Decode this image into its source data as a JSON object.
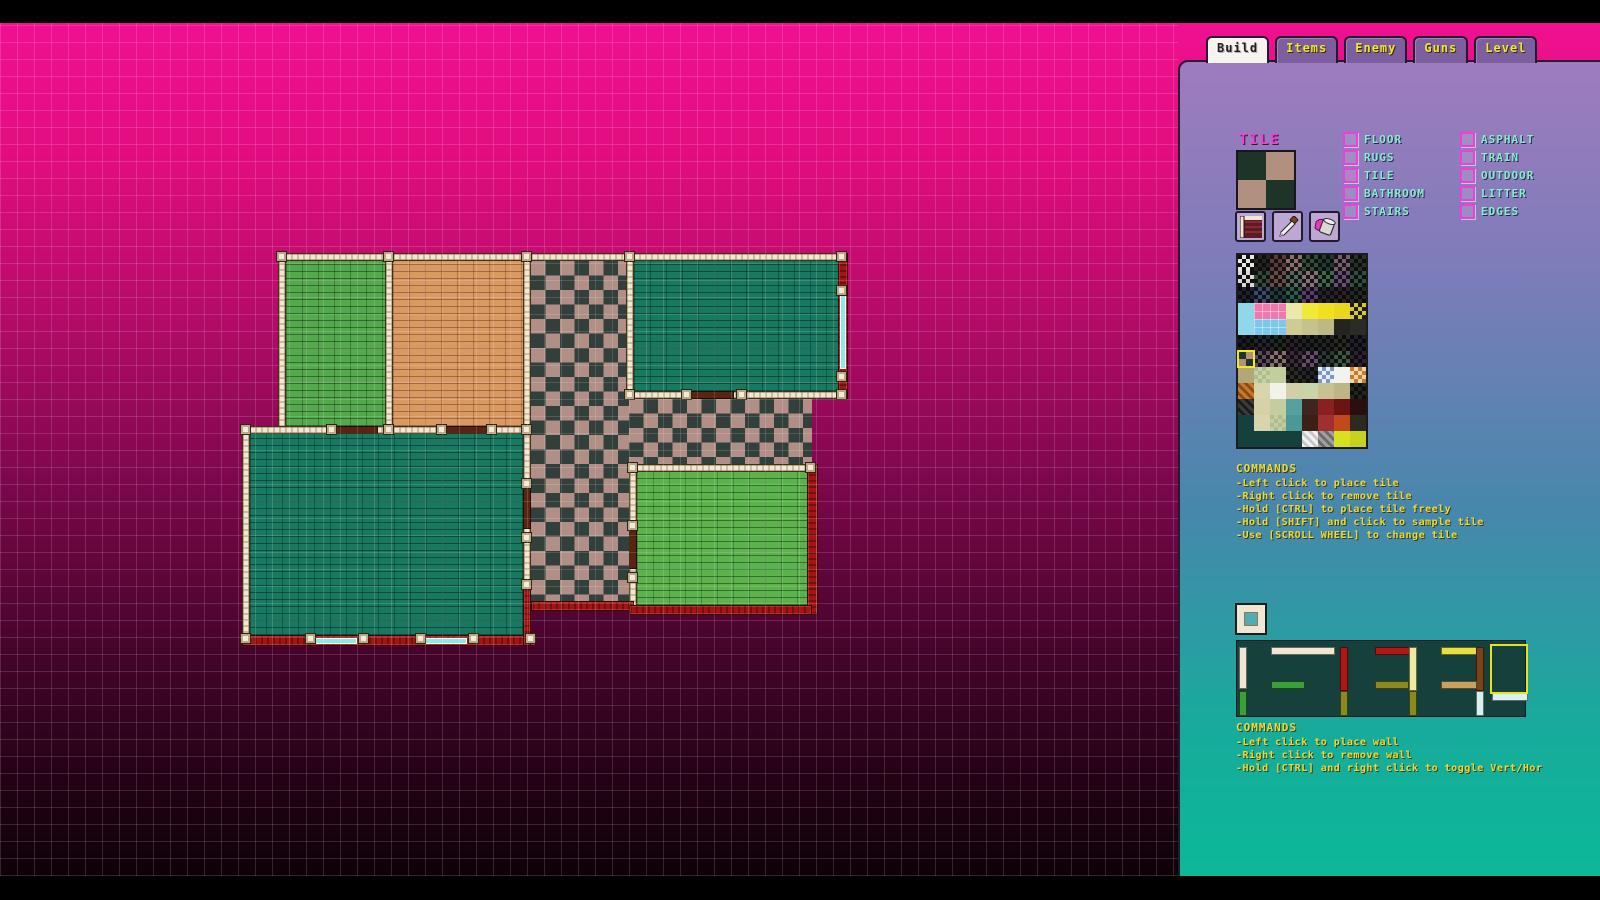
{
  "tabs": [
    {
      "label": "Build",
      "active": true
    },
    {
      "label": "Items",
      "active": false
    },
    {
      "label": "Enemy",
      "active": false
    },
    {
      "label": "Guns",
      "active": false
    },
    {
      "label": "Level",
      "active": false
    }
  ],
  "tile_section": {
    "title": "TILE",
    "preview_colors": {
      "dark": "#1f3428",
      "light": "#b2907f"
    },
    "tools": [
      "wall-pattern-tool",
      "eyedropper-tool",
      "paint-bucket-tool"
    ],
    "categories_col1": [
      {
        "label": "FLOOR",
        "checked": false
      },
      {
        "label": "RUGS",
        "checked": false
      },
      {
        "label": "TILE",
        "checked": true
      },
      {
        "label": "BATHROOM",
        "checked": false
      },
      {
        "label": "STAIRS",
        "checked": false
      }
    ],
    "categories_col2": [
      {
        "label": "ASPHALT",
        "checked": false
      },
      {
        "label": "TRAIN",
        "checked": false
      },
      {
        "label": "OUTDOOR",
        "checked": false
      },
      {
        "label": "LITTER",
        "checked": false
      },
      {
        "label": "EDGES",
        "checked": false
      }
    ]
  },
  "tile_commands": {
    "title": "COMMANDS",
    "lines": [
      "-Left click to place tile",
      "-Right click to remove tile",
      "-Hold [CTRL] to place tile freely",
      "-Hold [SHIFT] and click to sample tile",
      "-Use [SCROLL WHEEL] to change tile"
    ]
  },
  "wall_commands": {
    "title": "COMMANDS",
    "lines": [
      "-Left click to place wall",
      "-Right click to remove wall",
      "-Hold [CTRL] and right click to toggle Vert/Hor"
    ]
  },
  "tile_palette": {
    "cell": 16,
    "selected": {
      "row": 6,
      "col": 0
    },
    "rows": [
      [
        "chk:#e8e8e8/#111111",
        "chk:#23231f/#0d0d0d",
        "chk:#5e3a38/#121212",
        "chk:#8d6f6b/#161616",
        "chk:#2f4f38/#101010",
        "chk:#1f3b33/#0e0e0e",
        "chk:#7d5a74/#141414",
        "chk:#28322a/#0e0e0e"
      ],
      [
        "chk:#101010/#d8d8d8",
        "chk:#334b3b/#101010",
        "chk:#6e4a42/#121212",
        "chk:#56695e/#111111",
        "chk:#8d6f77/#151515",
        "chk:#3d6b4a/#111111",
        "chk:#6b4a7d/#131313",
        "chk:#2f4f3f/#0f0f0f"
      ],
      [
        "chk:#1b2333/#0b0b0b",
        "chk:#3b4b6b/#10101a",
        "chk:#1f3b3b/#0b1111",
        "chk:#2f5b4b/#0e1414",
        "chk:#5b3b6b/#120e16",
        "chk:#23232b/#0c0c0c",
        "chk:#2b2323/#0c0c0c",
        "chk:#1f2b23/#0b0b0b"
      ],
      [
        "sol:#8fd8ea",
        "tile:#f279ac",
        "tile:#f279ac",
        "sol:#ece9a8",
        "sol:#f2e83a",
        "sol:#f2e020",
        "sol:#ead820",
        "chk:#d8c820/#1a1a10"
      ],
      [
        "sol:#8fd8ea",
        "tile:#7cc8ea",
        "tile:#7cc8ea",
        "sol:#cfcb96",
        "sol:#c6c28e",
        "sol:#bdb986",
        "sol:#23231f",
        "sol:#2b2b27"
      ],
      [
        "chk:#1b1b1b/#0a0a0a",
        "chk:#23232b/#0b0b0b",
        "chk:#1f2b1f/#0a0a0a",
        "chk:#2b1f2b/#0b0b0b",
        "chk:#1b2323/#0a0a0a",
        "chk:#232323/#0b0b0b",
        "chk:#2b2b1f/#0b0b0b",
        "chk:#1f1f2b/#0a0a0a"
      ],
      [
        "quad:#1f3428/#b2907f",
        "chk:#5b4b5b/#121212",
        "chk:#8d6f6b/#161616",
        "chk:#3b2b3b/#0e0e0e",
        "chk:#6b4a6b/#131313",
        "chk:#2b3b33/#0d0d0d",
        "chk:#3d5b43/#101010",
        "chk:#2b2333/#0d0d0d"
      ],
      [
        "sol:#b0a878",
        "chk:#c6d2a2/#aebc8e",
        "sol:#c2ce9e",
        "chk:#2b2b23/#0e0e0e",
        "chk:#23232b/#0d0d0d",
        "chk:#7c96c8/#e8eef6",
        "sol:#f2f2ee",
        "chk:#ead8a0/#c87830"
      ],
      [
        "diag:#c87828/#8a4a14",
        "sol:#d8d5ac",
        "sol:#f2f2ea",
        "sol:#d2cfa6",
        "sol:#c9d5a9",
        "sol:#c6c292",
        "sol:#bab686",
        "chk:#23231f/#0d0d0d"
      ],
      [
        "diag:#3b3b3b/#1a1a1a",
        "sol:#d5d2a9",
        "sol:#c2ce9e",
        "sol:#56a0a0",
        "sol:#402420",
        "sol:#8a2020",
        "sol:#6b1414",
        "sol:#2b0e0e"
      ],
      [
        "sol:#173f3f",
        "sol:#d8d5ac",
        "chk:#c2ce9e/#aebc8e",
        "sol:#4a9898",
        "sol:#3b2016",
        "sol:#a03030",
        "sol:#c24a1a",
        "sol:#2b2b23"
      ],
      [
        "sol:#16403c",
        "sol:#16403c",
        "sol:#16403c",
        "sol:#16403c",
        "diag:#f2f2f2/#c8c8c8",
        "diag:#a0a0a0/#6b6b6b",
        "sol:#d8e020",
        "sol:#c8d020"
      ]
    ]
  },
  "wall_palette": {
    "bg": "#16403c",
    "segments": [
      {
        "x": 2,
        "y": 6,
        "w": 8,
        "h": 42,
        "c": "#efe7d3"
      },
      {
        "x": 2,
        "y": 50,
        "w": 8,
        "h": 25,
        "c": "#3aa03a"
      },
      {
        "x": 34,
        "y": 6,
        "w": 64,
        "h": 8,
        "c": "#efe7d3"
      },
      {
        "x": 34,
        "y": 40,
        "w": 34,
        "h": 8,
        "c": "#3aa03a"
      },
      {
        "x": 103,
        "y": 6,
        "w": 8,
        "h": 44,
        "c": "#b01818"
      },
      {
        "x": 103,
        "y": 50,
        "w": 8,
        "h": 25,
        "c": "#8a8a20"
      },
      {
        "x": 138,
        "y": 6,
        "w": 38,
        "h": 8,
        "c": "#b01818"
      },
      {
        "x": 172,
        "y": 6,
        "w": 8,
        "h": 44,
        "c": "#ece9a0"
      },
      {
        "x": 138,
        "y": 40,
        "w": 34,
        "h": 8,
        "c": "#8a8a20"
      },
      {
        "x": 172,
        "y": 50,
        "w": 8,
        "h": 25,
        "c": "#8a8a20"
      },
      {
        "x": 204,
        "y": 6,
        "w": 40,
        "h": 8,
        "c": "#e8e040"
      },
      {
        "x": 239,
        "y": 6,
        "w": 8,
        "h": 44,
        "c": "#7a4418"
      },
      {
        "x": 204,
        "y": 40,
        "w": 36,
        "h": 8,
        "c": "#c8a060"
      },
      {
        "x": 239,
        "y": 50,
        "w": 8,
        "h": 25,
        "c": "#d8f0f0"
      },
      {
        "x": 255,
        "y": 52,
        "w": 36,
        "h": 8,
        "c": "#d8f0f0"
      }
    ],
    "selected": {
      "x": 253,
      "y": 3,
      "w": 38,
      "h": 50
    }
  },
  "canvas": {
    "floors": [
      {
        "x": 286,
        "y": 238,
        "w": 99,
        "h": 165,
        "f": "greenBrick"
      },
      {
        "x": 393,
        "y": 238,
        "w": 130,
        "h": 165,
        "f": "orangeBrick"
      },
      {
        "x": 531,
        "y": 238,
        "w": 98,
        "h": 342,
        "f": "checker"
      },
      {
        "x": 634,
        "y": 238,
        "w": 204,
        "h": 130,
        "f": "tealBrick"
      },
      {
        "x": 629,
        "y": 376,
        "w": 183,
        "h": 65,
        "f": "checker"
      },
      {
        "x": 250,
        "y": 411,
        "w": 273,
        "h": 201,
        "f": "tealBrick"
      },
      {
        "x": 637,
        "y": 449,
        "w": 170,
        "h": 133,
        "f": "greenBrick2"
      }
    ],
    "white_walls": [
      {
        "x": 278,
        "y": 230,
        "w": 570,
        "h": 8
      },
      {
        "x": 278,
        "y": 230,
        "w": 8,
        "h": 181
      },
      {
        "x": 385,
        "y": 230,
        "w": 8,
        "h": 181
      },
      {
        "x": 523,
        "y": 230,
        "w": 8,
        "h": 181
      },
      {
        "x": 626,
        "y": 230,
        "w": 8,
        "h": 146
      },
      {
        "x": 626,
        "y": 368,
        "w": 222,
        "h": 8
      },
      {
        "x": 242,
        "y": 403,
        "w": 289,
        "h": 8
      },
      {
        "x": 242,
        "y": 403,
        "w": 8,
        "h": 220
      },
      {
        "x": 523,
        "y": 411,
        "w": 8,
        "h": 149
      },
      {
        "x": 629,
        "y": 441,
        "w": 183,
        "h": 8
      },
      {
        "x": 629,
        "y": 441,
        "w": 8,
        "h": 151
      }
    ],
    "red_walls": [
      {
        "x": 838,
        "y": 230,
        "w": 10,
        "h": 146
      },
      {
        "x": 242,
        "y": 612,
        "w": 294,
        "h": 11
      },
      {
        "x": 523,
        "y": 560,
        "w": 8,
        "h": 63
      },
      {
        "x": 531,
        "y": 578,
        "w": 103,
        "h": 10
      },
      {
        "x": 807,
        "y": 441,
        "w": 11,
        "h": 151
      },
      {
        "x": 629,
        "y": 582,
        "w": 183,
        "h": 10
      }
    ],
    "windows": [
      {
        "x": 840,
        "y": 268,
        "w": 6,
        "h": 78
      },
      {
        "x": 312,
        "y": 615,
        "w": 45,
        "h": 6
      },
      {
        "x": 422,
        "y": 615,
        "w": 45,
        "h": 6
      }
    ],
    "doors": [
      {
        "x": 328,
        "y": 403,
        "w": 50,
        "h": 8
      },
      {
        "x": 438,
        "y": 403,
        "w": 50,
        "h": 8
      },
      {
        "x": 688,
        "y": 368,
        "w": 46,
        "h": 8
      },
      {
        "x": 523,
        "y": 460,
        "w": 8,
        "h": 46
      },
      {
        "x": 629,
        "y": 502,
        "w": 8,
        "h": 44
      }
    ],
    "posts": [
      [
        276,
        228
      ],
      [
        383,
        228
      ],
      [
        521,
        228
      ],
      [
        624,
        228
      ],
      [
        836,
        228
      ],
      [
        240,
        401
      ],
      [
        326,
        401
      ],
      [
        383,
        401
      ],
      [
        436,
        401
      ],
      [
        486,
        401
      ],
      [
        521,
        401
      ],
      [
        624,
        366
      ],
      [
        681,
        366
      ],
      [
        736,
        366
      ],
      [
        836,
        366
      ],
      [
        240,
        610
      ],
      [
        305,
        610
      ],
      [
        358,
        610
      ],
      [
        415,
        610
      ],
      [
        468,
        610
      ],
      [
        525,
        610
      ],
      [
        627,
        439
      ],
      [
        805,
        439
      ],
      [
        521,
        455
      ],
      [
        521,
        509
      ],
      [
        521,
        556
      ],
      [
        627,
        497
      ],
      [
        627,
        549
      ],
      [
        836,
        262
      ],
      [
        836,
        348
      ]
    ]
  },
  "colors": {
    "wall_white": "#efe7d3",
    "wall_red": "#a31414",
    "window": "#8fe8e2",
    "door": "#5a2410",
    "selection_yellow": "#f2e820",
    "accent_magenta": "#f23fd2",
    "label_teal": "#8ceccb",
    "command_yellow": "#eadc3c"
  }
}
